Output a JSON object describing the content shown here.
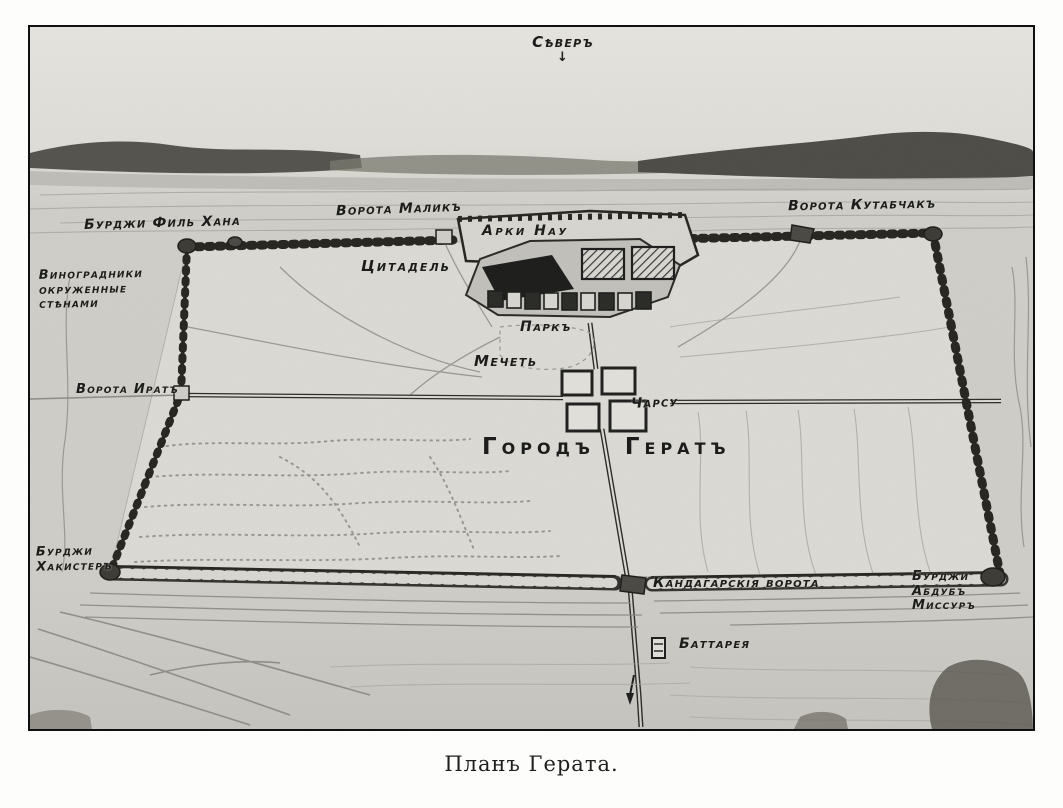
{
  "map": {
    "caption": "Планъ Герата.",
    "labels": {
      "north": "Сѣверъ",
      "north_arrow": "↓",
      "burji_fil_khana": "Бурджи Филь Хана",
      "vineyards_line1": "Виноградники",
      "vineyards_line2": "окруженные",
      "vineyards_line3": "стѣнами",
      "vorota_malik": "Ворота Маликъ",
      "arki_nau": "Арки Нау",
      "citadel": "Цитадель",
      "vorota_kutabchak": "Ворота Кутабчакъ",
      "park": "Паркъ",
      "mosque": "Мечеть",
      "vorota_irat": "Ворота Иратъ",
      "charsu": "Чарсу",
      "city_word1": "Городъ",
      "city_word2": "Гератъ",
      "burji_khakister_line1": "Бурджи",
      "burji_khakister_line2": "Хакистеръ",
      "kandahar_gate": "Кандагарскія ворота",
      "burji_abdub_line1": "Бурджи",
      "burji_abdub_line2": "Абдубъ",
      "burji_abdub_line3": "Миссуръ",
      "battery": "Баттарея"
    },
    "colors": {
      "ink": "#1d1d1b",
      "paper": "#d9d8d2",
      "sky": "#e4e3de",
      "mountain": "#4e4c47",
      "wall": "#302f2b"
    }
  }
}
